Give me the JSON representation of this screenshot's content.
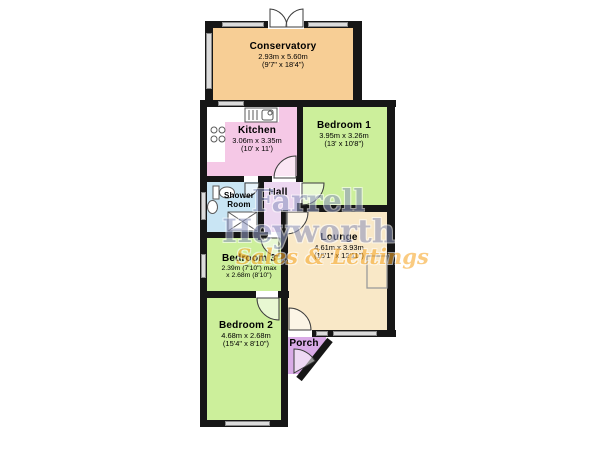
{
  "watermark": {
    "line1": "Farrell",
    "line2": "Heyworth",
    "tagline": "Sales & Lettings",
    "text_color": "#8f97c0",
    "tagline_color": "#f7a728"
  },
  "structure_colors": {
    "wall": "#161616",
    "window": "#dcdcdc"
  },
  "rooms": [
    {
      "id": "conservatory",
      "name": "Conservatory",
      "dim1": "2.93m x 5.60m",
      "dim2": "(9'7\" x 18'4\")",
      "color": "#f7ce95"
    },
    {
      "id": "kitchen",
      "name": "Kitchen",
      "dim1": "3.06m x 3.35m",
      "dim2": "(10' x 11')",
      "color": "#f5c8e6"
    },
    {
      "id": "bedroom1",
      "name": "Bedroom 1",
      "dim1": "3.95m x 3.26m",
      "dim2": "(13' x 10'8\")",
      "color": "#ccef9b"
    },
    {
      "id": "hall",
      "name": "Hall",
      "color": "#ecd7f0"
    },
    {
      "id": "shower-room",
      "name": "Shower Room",
      "color": "#c9e5f4"
    },
    {
      "id": "lounge",
      "name": "Lounge",
      "dim1": "4.61m x 3.93m",
      "dim2": "(15'1\" x 12'11\")",
      "color": "#f9e8c7"
    },
    {
      "id": "bedroom3",
      "name": "Bedroom 3",
      "dim1": "2.39m (7'10\") max",
      "dim2": "x 2.68m (8'10\")",
      "color": "#ccef9b"
    },
    {
      "id": "bedroom2",
      "name": "Bedroom 2",
      "dim1": "4.68m x 2.68m",
      "dim2": "(15'4\" x 8'10\")",
      "color": "#ccef9b"
    },
    {
      "id": "porch",
      "name": "Porch",
      "color": "#d9abe7"
    }
  ]
}
